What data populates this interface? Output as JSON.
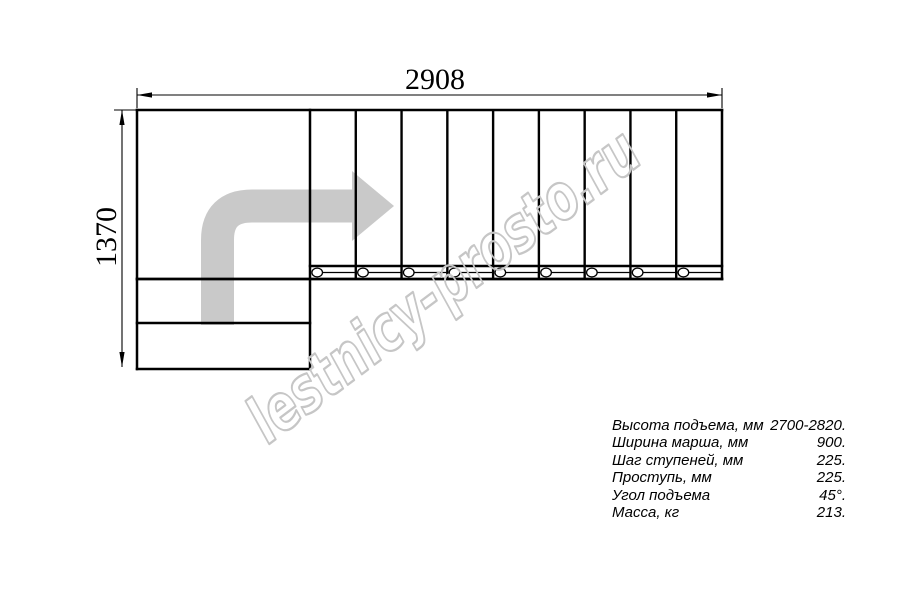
{
  "drawing": {
    "width_dimension_label": "2908",
    "height_dimension_label": "1370",
    "flight_steps": 9,
    "lower_steps": 2,
    "line_color": "#000000",
    "arrow_color": "#c9c9c9"
  },
  "watermark": {
    "text": "lestnicy-prosto.ru",
    "color": "#c6c6c6"
  },
  "specs": {
    "rows": [
      {
        "label": "Высота подъема, мм",
        "value": "2700-2820."
      },
      {
        "label": "Ширина марша, мм",
        "value": "900."
      },
      {
        "label": "Шаг ступеней, мм",
        "value": "225."
      },
      {
        "label": "Проступь, мм",
        "value": "225."
      },
      {
        "label": "Угол подъема",
        "value": "45°."
      },
      {
        "label": "Масса, кг",
        "value": "213."
      }
    ]
  }
}
